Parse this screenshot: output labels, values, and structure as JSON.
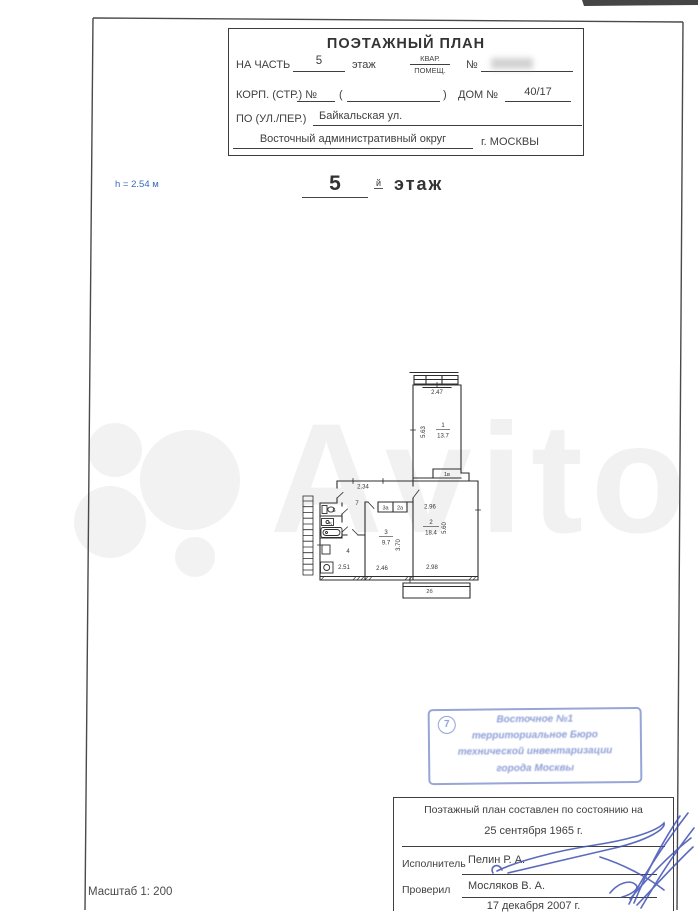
{
  "header_box": {
    "title": "ПОЭТАЖНЫЙ ПЛАН",
    "na_chast_label": "НА ЧАСТЬ",
    "na_chast_value": "5",
    "etazh_label": "этаж",
    "kvar_label": "КВАР.",
    "pomesh_label": "ПОМЕЩ.",
    "num_label": "№",
    "korp_label": "КОРП. (СТР.) №",
    "paren_open": "(",
    "paren_close": ")",
    "dom_label": "ДОМ №",
    "dom_value": "40/17",
    "street_label": "ПО (УЛ./ПЕР.)",
    "street_value": "Байкальская ул.",
    "district_value": "Восточный административный округ",
    "city_value": "г. МОСКВЫ"
  },
  "floor_heading": {
    "height_note": "h = 2.54 м",
    "number": "5",
    "suffix": "й",
    "word": "этаж"
  },
  "plan": {
    "labels": {
      "dim1_top": "2.47",
      "dim1_left": "5.63",
      "room1_num": "1",
      "room1_area": "13.7",
      "closet_1v": "1в",
      "dim_hall_top": "2.34",
      "hall_num": "7",
      "closet_3a": "3а",
      "closet_2a": "2а",
      "dim2_top": "2.96",
      "room2_num": "2",
      "room2_area": "18.4",
      "dim2_right": "5.60",
      "dim2_bottom": "2.98",
      "room3_num": "3",
      "room3_area": "9.7",
      "dim3_right": "3.70",
      "dim3_bottom": "2.46",
      "wc_num": "6",
      "bath_num": "5",
      "kitchen_num": "4",
      "dim4_bottom": "2.51",
      "balcony_label": "2б"
    }
  },
  "watermark": {
    "text": "Avito"
  },
  "stamp": {
    "number": "7",
    "line1": "Восточное №1",
    "line2": "территориальное Бюро",
    "line3": "технической инвентаризации",
    "line4": "города Москвы"
  },
  "footer_table": {
    "title": "Поэтажный план составлен по состоянию на",
    "survey_date": "25 сентября 1965 г.",
    "executor_label": "Исполнитель",
    "executor_name": "Пелин Р. А.",
    "checker_label": "Проверил",
    "checker_name": "Мосляков В. А.",
    "issue_date": "17 декабря 2007 г."
  },
  "scale_note": "Масштаб 1: 200",
  "colors": {
    "ink": "#3c3c3c",
    "plan_line": "#2d2d2d",
    "note_blue": "#3a6ab8",
    "stamp_blue": "#8fa0d8",
    "signature_blue": "#3f51b5",
    "watermark_gray": "#f1f1f1"
  }
}
